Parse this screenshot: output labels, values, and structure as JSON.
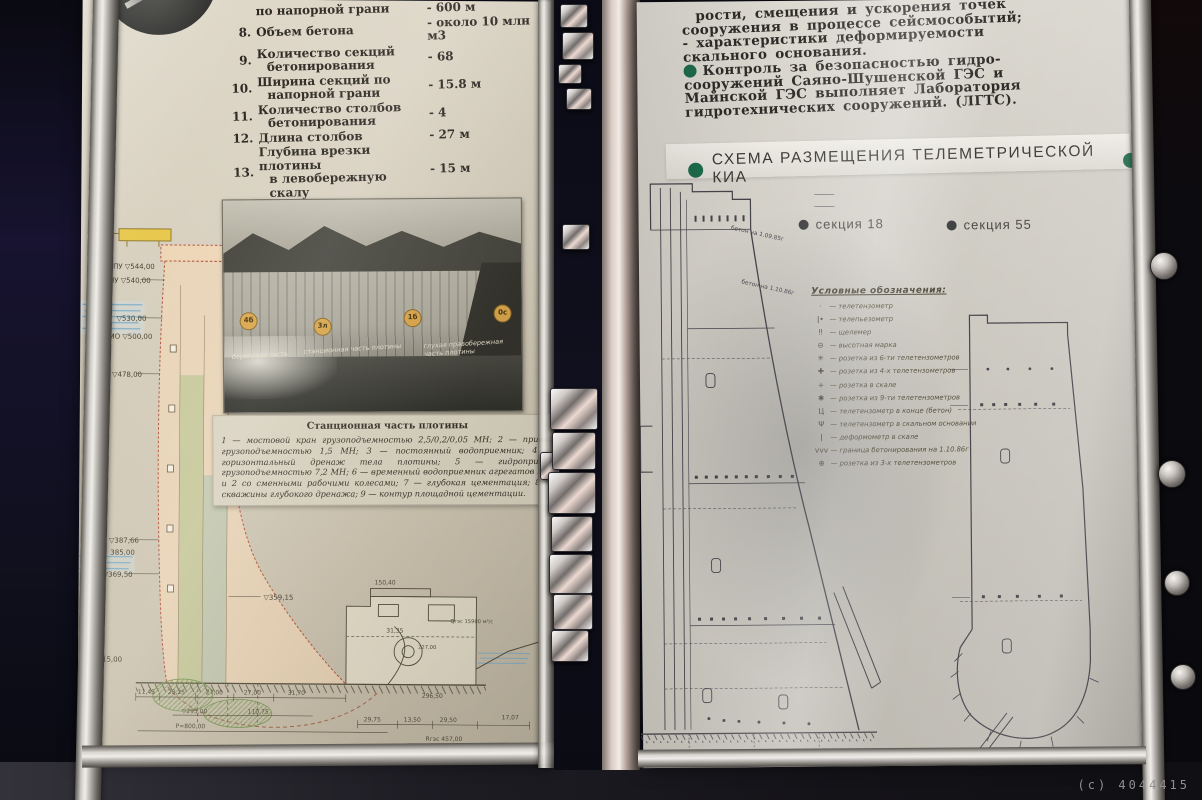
{
  "watermark": "(с) 4044415",
  "left_page": {
    "specs": {
      "items": [
        {
          "num": "",
          "l1": "по напорной грани",
          "l2": "",
          "val": "- 600 м"
        },
        {
          "num": "8.",
          "l1": "Объем бетона",
          "l2": "",
          "val": "- около 10 млн м3"
        },
        {
          "num": "9.",
          "l1": "Количество секций",
          "l2": "бетонирования",
          "val": "- 68"
        },
        {
          "num": "10.",
          "l1": "Ширина секций по",
          "l2": "напорной грани",
          "val": "- 15.8 м"
        },
        {
          "num": "11.",
          "l1": "Количество столбов",
          "l2": "бетонирования",
          "val": "- 4"
        },
        {
          "num": "12.",
          "l1": "Длина столбов",
          "l2": "",
          "val": "- 27 м"
        },
        {
          "num": "13.",
          "l1": "Глубина врезки плотины",
          "l2": "в левобережную скалу",
          "val": "- 15 м"
        },
        {
          "num": "14.",
          "l1": "Глубина врезки плотины",
          "l2": "в правобережную скалу",
          "val": "- 10 м"
        },
        {
          "num": "15.",
          "l1": "Врезка основания плотины",
          "l2": "в русло на глубину",
          "val": "- 5 м"
        }
      ]
    },
    "photo": {
      "markers": [
        "4б",
        "3л",
        "1б",
        "0с"
      ],
      "labels": [
        "береговая часть",
        "станционная часть плотины",
        "глухая правобережная часть плотины"
      ],
      "caption_title": "Станционная часть плотины",
      "caption_text": "1 — мостовой кран грузоподъемностью 2,5/0,2/0,05 МН; 2 — привод грузоподъемностью 1,5 МН; 3 — постоянный водоприемник; 4 — горизонтальный дренаж тела плотины; 5 — гидропривод грузоподъемностью 7,2 МН; 6 — временный водоприемник агрегатов № 1 и 2 со сменными рабочими колесами; 7 — глубокая цементация; 8 — скважины глубокого дренажа; 9 — контур площадной цементации."
    },
    "drawing": {
      "elev": {
        "e544": "ФПУ ▽544,00",
        "e540": "НПУ ▽540,00",
        "e530": "▽530,00",
        "e500": "УМО ▽500,00",
        "e478": "▽478,00",
        "e38766": "▽387,66",
        "e385": "385,00",
        "e3695": "▽369,50",
        "e35915": "▽359,15",
        "e315": "315,00"
      },
      "dims": {
        "d1": "11,45",
        "d2": "23,25",
        "d3": "27,00",
        "d4": "27,00",
        "d5": "31,70",
        "d6": "▽295,00",
        "d7": "110,75",
        "d8": "Р=800,00",
        "d9": "29,75",
        "d10": "13,50",
        "d11": "29,50",
        "d12": "17,07",
        "d13": "296,50",
        "d14": "Rгэс 457,00",
        "d15": "150,40",
        "d16": "31,35",
        "d17": "Qгэс 15900 м³/с",
        "d18": "227,00"
      }
    }
  },
  "right_page": {
    "intro": {
      "l0": "рости, смещения и ускорения точек",
      "l1": "сооружения в процессе сейсмособытий;",
      "l2": "- характеристики  деформируемости",
      "l3": "скального  основания.",
      "l4": "Контроль за безопасностью гидро-",
      "l5": "сооружений Саяно-Шушенской ГЭС и",
      "l6": "Майнской ГЭС выполняет Лаборатория",
      "l7": "гидротехнических сооружений. (ЛГТС)."
    },
    "title": "СХЕМА РАЗМЕЩЕНИЯ ТЕЛЕМЕТРИЧЕСКОЙ КИА",
    "section_labels": {
      "s18": "секция 18",
      "s55": "секция 55"
    },
    "legend": {
      "title": "Условные обозначения:",
      "items": [
        {
          "sym": "·",
          "label": "— телетензометр"
        },
        {
          "sym": "ǀ•",
          "label": "— телепьезометр"
        },
        {
          "sym": "‼",
          "label": "— щелемер"
        },
        {
          "sym": "⊖",
          "label": "— высотная марка"
        },
        {
          "sym": "✳",
          "label": "— розетка из 6-ти телетензометров"
        },
        {
          "sym": "✚",
          "label": "— розетка из 4-х телетензометров"
        },
        {
          "sym": "+",
          "label": "— розетка в скале"
        },
        {
          "sym": "✱",
          "label": "— розетка из 9-ти телетензометров"
        },
        {
          "sym": "Ц",
          "label": "— телетензометр в конце (бетон)"
        },
        {
          "sym": "Ψ",
          "label": "— телетензометр в скальном основании"
        },
        {
          "sym": "ǀ",
          "label": "— деформометр в скале"
        },
        {
          "sym": "vvv",
          "label": "— граница бетонирования на 1.10.86г"
        },
        {
          "sym": "⊕",
          "label": "— розетка из 3-х телетензометров"
        }
      ]
    },
    "annotations": {
      "a1": "бетон на 1.09.85г",
      "a2": "бетон на 1.10.86г"
    }
  },
  "colors": {
    "green_bullet": "#1e6b4c",
    "dark_bullet": "#3c3c3c",
    "dam_fill": "#eed6b6",
    "dam_edge": "#b5553d",
    "water": "#7fb0ca",
    "crane": "#e8c84e",
    "marker_orange": "#d9a54a",
    "pencil_ink": "#45434a",
    "brown_ink": "#57503f"
  }
}
